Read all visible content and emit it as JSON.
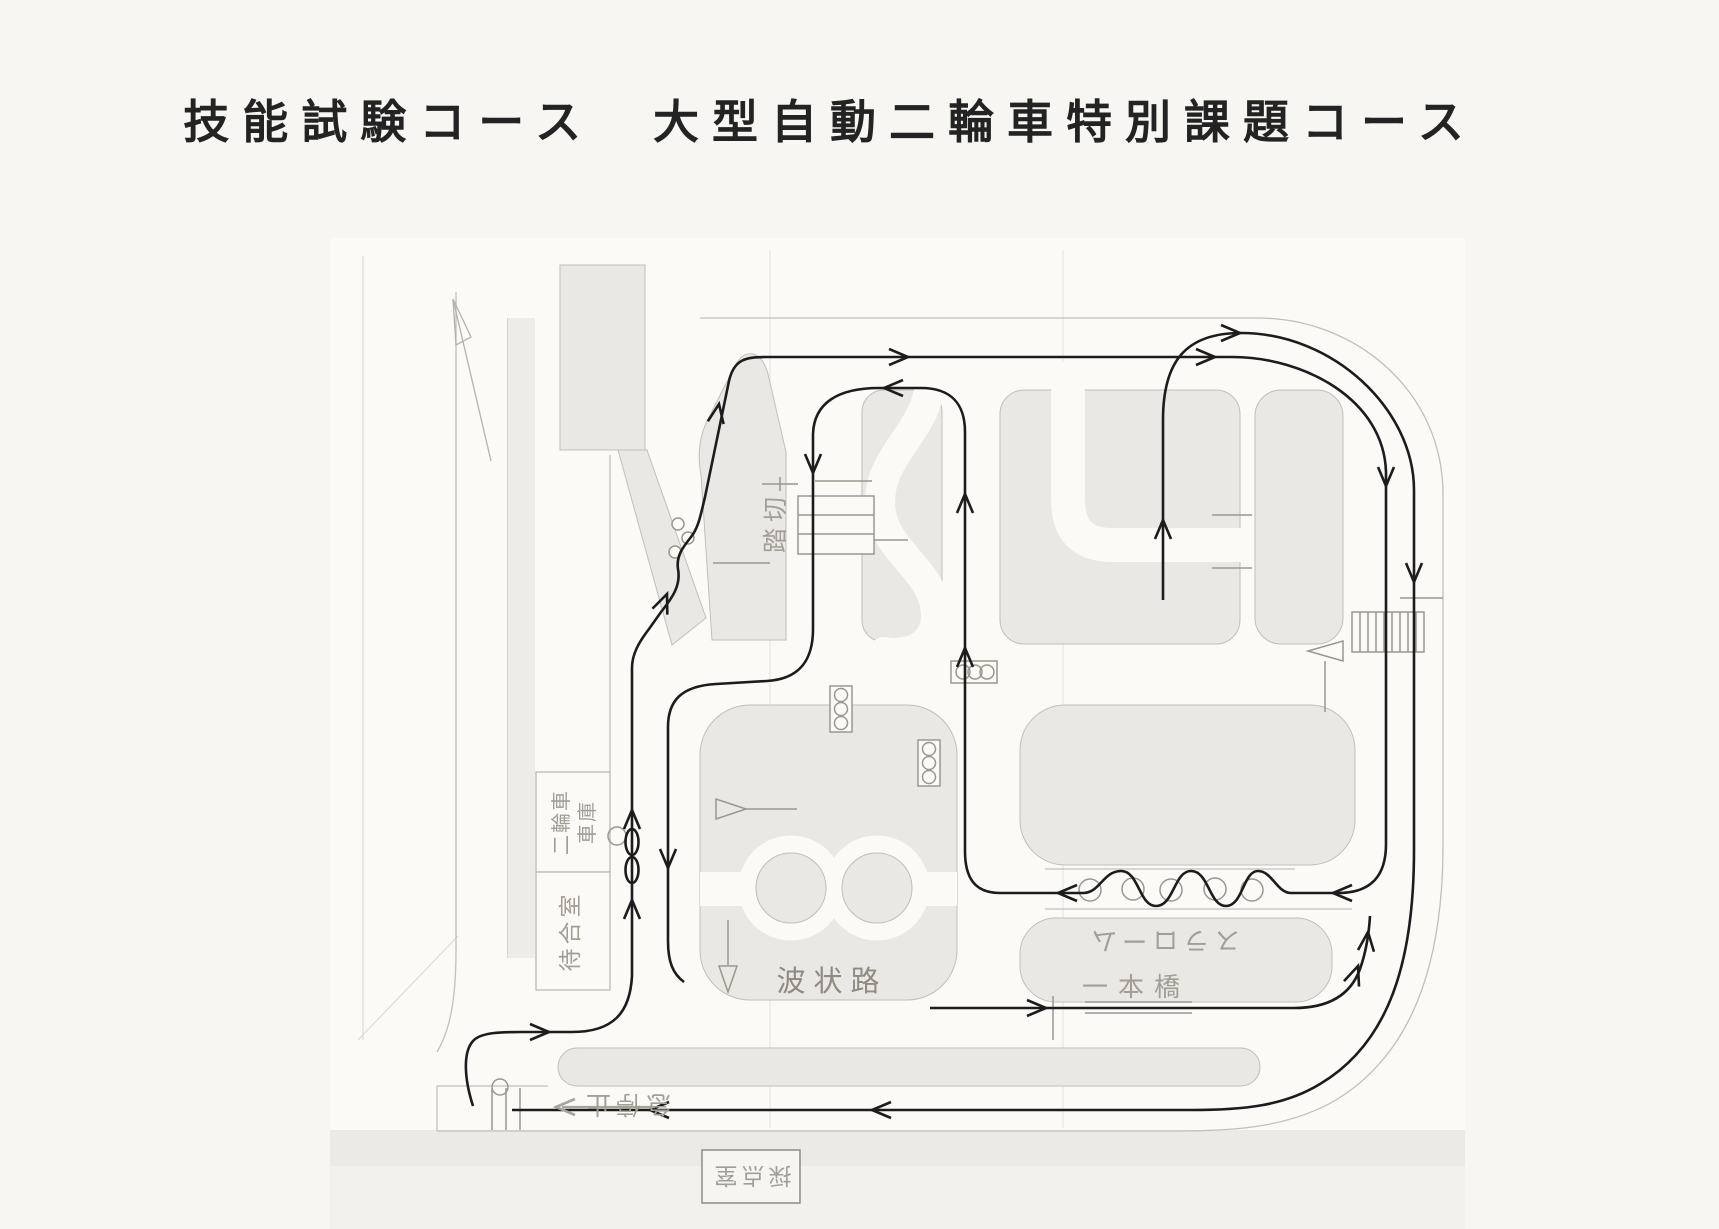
{
  "title": "技能試験コース　大型自動二輪車特別課題コース",
  "map": {
    "labels": {
      "railroad_crossing": "踏切",
      "garage_line1": "二輪車",
      "garage_line2": "車庫",
      "waiting_room": "待合室",
      "slalom": "スラローム",
      "balance_beam": "一本橋",
      "wavy_road": "波状路",
      "sudden_stop": "急停止",
      "scoring_room": "採点室"
    },
    "colors": {
      "paper": "#f7f6f3",
      "sheet": "#fbfaf7",
      "island_fill": "#e9e8e4",
      "island_outline": "#c2bfb9",
      "symbol_gray": "#9a978f",
      "label_gray": "#a29e96",
      "route_black": "#1c1c1c"
    }
  }
}
